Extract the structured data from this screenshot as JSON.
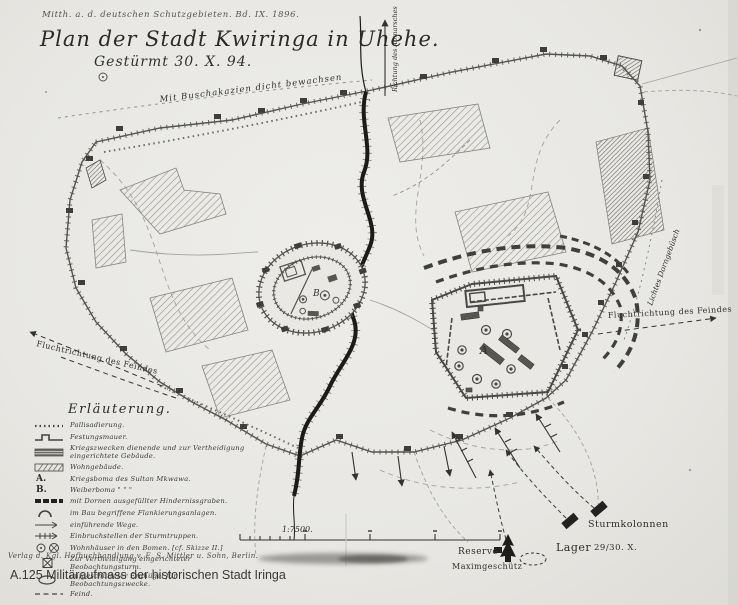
{
  "header": {
    "source_note": "Mitth. a. d. deutschen Schutzgebieten. Bd. IX. 1896.",
    "title": "Plan der Stadt Kwiringa in Uhehe.",
    "subtitle": "Gestürmt 30. X. 94."
  },
  "map_labels": {
    "vegetation_top": "Mit Buschakazien dicht bewachsen",
    "direction_of_departure": "Richtung des Abmarsches",
    "enemy_flight_left": "Fluchtrichtung des Feindes",
    "enemy_flight_right": "Fluchtrichtung des Feindes",
    "thornbush_right": "Lichtes Dorngebüsch",
    "fort_a_letter": "A",
    "fort_b_letter": "B",
    "storm_columns": "Sturmkolonnen",
    "camp_label": "Lager",
    "camp_date": "29/30. X.",
    "reserve": "Reserve",
    "maxim_gun": "Maximgeschütz",
    "scale": "1:7500."
  },
  "legend": {
    "heading": "Erläuterung.",
    "items": [
      {
        "symbol": "palisade-line",
        "label": "Pallisadierung."
      },
      {
        "symbol": "fortress-wall",
        "label": "Festungsmauer."
      },
      {
        "symbol": "military-building",
        "label": "Kriegszwecken dienende und zur Vertheidigung eingerichtete Gebäude."
      },
      {
        "symbol": "residential-building",
        "label": "Wohngebäude."
      },
      {
        "symbol": "letter-a",
        "prefix": "A.",
        "label": "Kriegsboma des Sultan Mkwawa."
      },
      {
        "symbol": "letter-b",
        "prefix": "B.",
        "label": "Weiberboma  \"      \"      \""
      },
      {
        "symbol": "thorn-ditch",
        "label": "mit Dornen ausgefüllter Hindernissgraben."
      },
      {
        "symbol": "flanking-works",
        "label": "im Bau begriffene Flankierungsanlagen."
      },
      {
        "symbol": "entry-roads",
        "label": "einführende Wege."
      },
      {
        "symbol": "breach-points",
        "label": "Einbruchstellen der Sturmtruppen."
      },
      {
        "symbol": "boma-houses",
        "label": "Wohnhäuser in den Bomen. [cf. Skizze II.]"
      },
      {
        "symbol": "observation-tower",
        "label": "Zur Vertheidigung eingerichteter Beobachtungsturm."
      },
      {
        "symbol": "observation-mound",
        "label": "aufgeschütteter Erdhügel für Beobachtungszwecke."
      },
      {
        "symbol": "enemy-line",
        "label": "Feind."
      }
    ]
  },
  "footer": {
    "publisher": "Verlag d. Kgl. Hofbuchhandlung v. E. S. Mittler u. Sohn, Berlin.",
    "caption": "A.125 Militäraufmass der historischen Stadt Iringa"
  },
  "colors": {
    "paper": "#e9e8e4",
    "ink": "#2f2e2b",
    "wall": "#55544f"
  }
}
